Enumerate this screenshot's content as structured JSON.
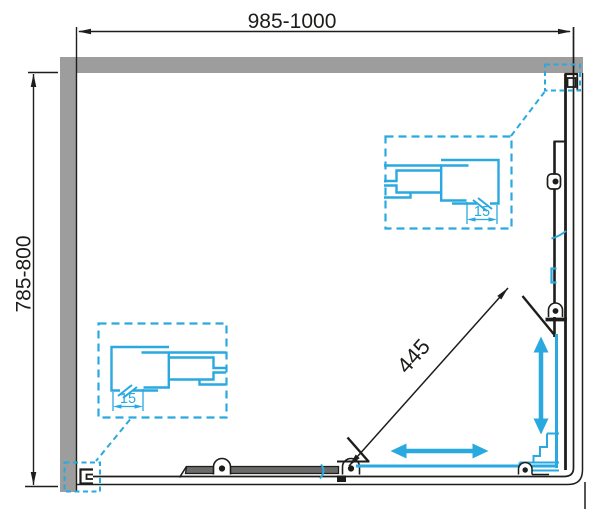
{
  "diagram": {
    "type": "technical-drawing-shower-enclosure-plan",
    "labels": {
      "width_dimension": "985-1000",
      "depth_dimension": "785-800",
      "diagonal_entry_dimension": "445",
      "detail_left_adjustment": "15",
      "detail_right_adjustment": "15"
    },
    "colors": {
      "background": "#ffffff",
      "wall_gray": "#9d9d9d",
      "line_black": "#1d1d1b",
      "accent_cyan": "#2aa9e0",
      "door_bar_gray": "#6b6b6b"
    }
  }
}
